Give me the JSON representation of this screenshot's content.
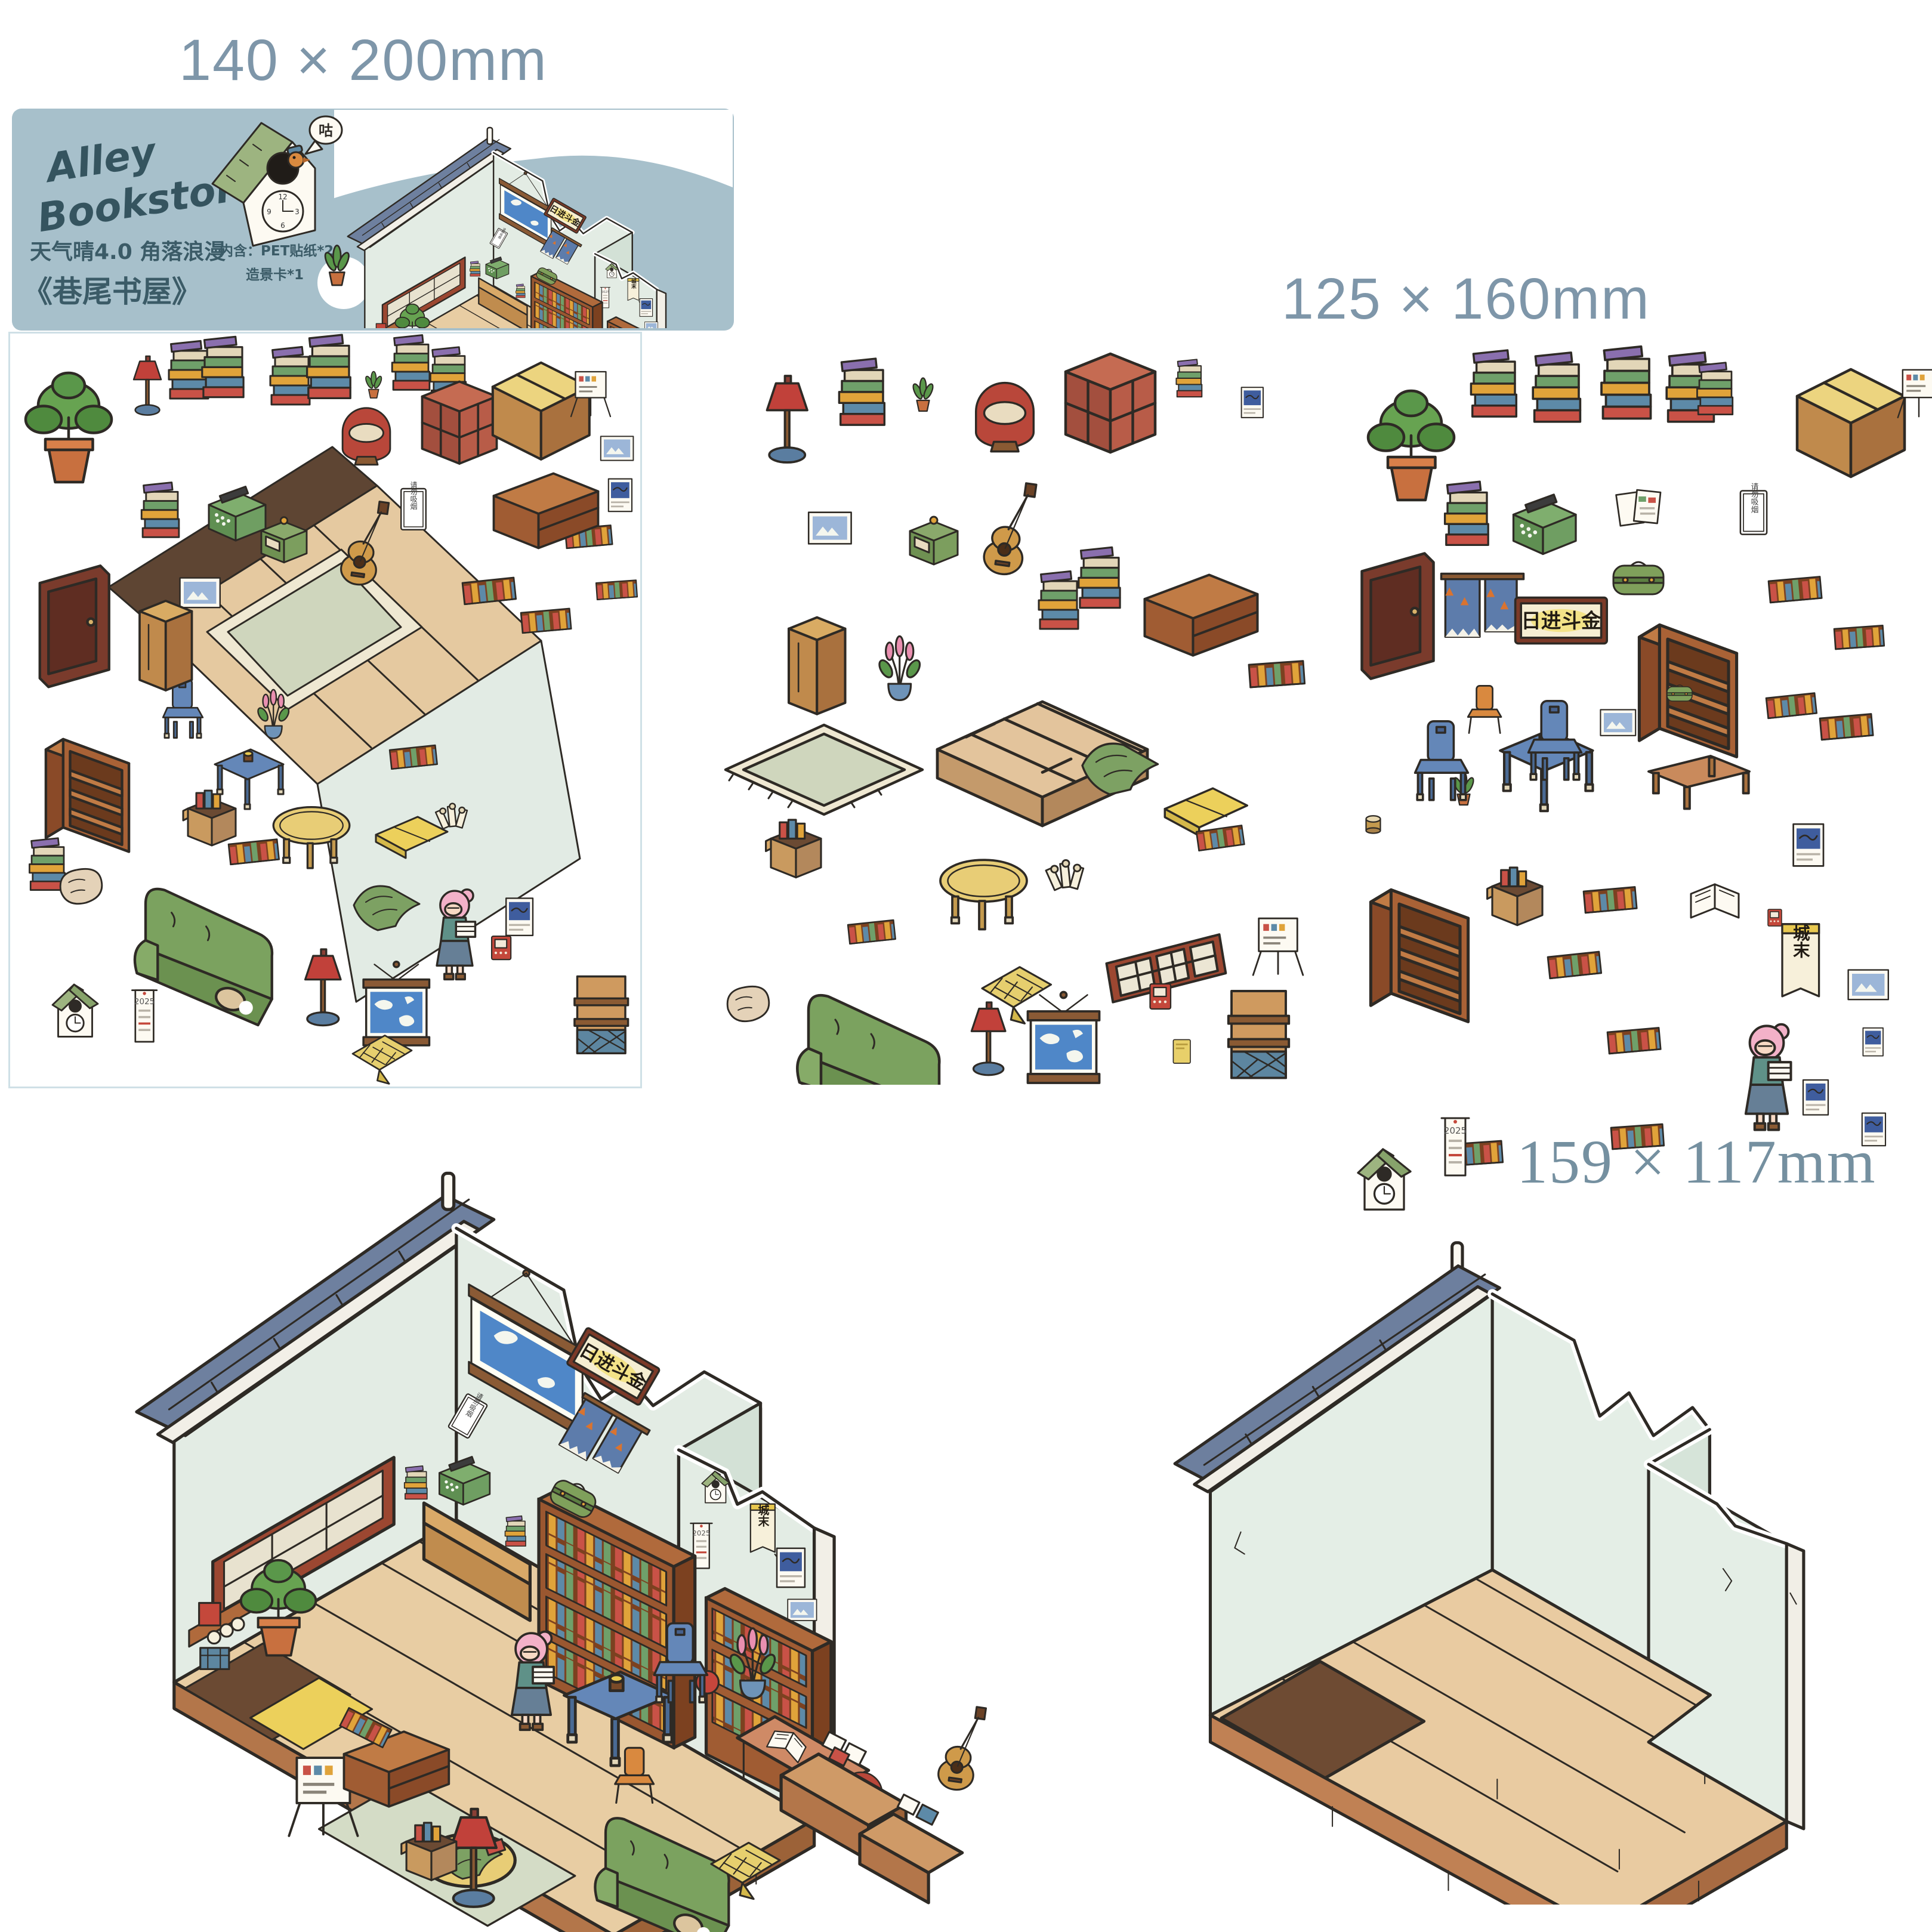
{
  "labels": {
    "package_size": "140 × 200mm",
    "sheet_size": "125 × 160mm",
    "scene_card_size": "159 × 117mm"
  },
  "package": {
    "brand_line1": "Alley",
    "brand_line2": "Bookstore",
    "series": "天气晴4.0 角落浪漫",
    "title": "《巷尾书屋》",
    "contents1": "内含：PET贴纸*2",
    "contents2": "造景卡*1",
    "clock_bubble": "咕",
    "clock": {
      "numerals": [
        "12",
        "3",
        "6",
        "9"
      ]
    },
    "bg_color": "#a7c0cb"
  },
  "artwork": {
    "plaque_text": "日进斗金",
    "scroll_text": "城末",
    "sign_text": "请勿吸烟",
    "calendar_year": "2025"
  },
  "sheets": {
    "sheet1": {
      "description": "PET sticker sheet with semi-assembled room piece",
      "items": [
        "potted-plant",
        "floor-lamp",
        "book-stacks",
        "red-armchair",
        "cube-shelf",
        "counter",
        "easel-sign",
        "typewriter",
        "gramophone-box",
        "guitar",
        "no-smoking-sign",
        "door",
        "wardrobe-column",
        "bookshelf",
        "sofa",
        "cuckoo-clock",
        "calendar",
        "floor-lamp",
        "world-map-scroll",
        "shop-girl",
        "magazine-rack",
        "wood-floor-piece",
        "rug",
        "blue-table",
        "flower-vase",
        "oval-table",
        "cushion",
        "blanket"
      ]
    },
    "sheet2": {
      "description": "PET sticker sheet of loose furniture",
      "items": [
        "floor-lamp",
        "book-stack",
        "flower-sprout",
        "red-armchair",
        "cube-shelf",
        "picture-frame",
        "gramophone-box",
        "guitar",
        "book-stacks",
        "low-cabinet",
        "wardrobe-column",
        "flower-vase",
        "wood-platform",
        "rug",
        "cardboard-box",
        "oval-table",
        "green-blanket",
        "yellow-cushion",
        "paper-rolls",
        "dust-pillow",
        "sofa",
        "yellow-cloth",
        "lattice-window",
        "easel-sign",
        "floor-lamp",
        "world-map-scroll",
        "mini-radio",
        "yellow-card",
        "magazine-rack"
      ]
    },
    "sheet3": {
      "description": "PET sticker sheet of bookstore fittings",
      "items": [
        "potted-plant",
        "book-stacks",
        "l-shaped-counter",
        "easel-sign",
        "typewriter",
        "menu-cards",
        "no-smoking-sign",
        "door",
        "noren-curtain",
        "calligraphy-plaque",
        "green-suitcase",
        "tall-bookshelf",
        "book-rows",
        "flower-sprout",
        "blue-table",
        "blue-chairs",
        "orange-chair",
        "low-table",
        "bookshelf",
        "cardboard-box",
        "open-book",
        "posters",
        "scroll-poster",
        "shop-girl",
        "cuckoo-clock",
        "calendar",
        "cup"
      ]
    },
    "scene_card": {
      "description": "empty isometric room scene card"
    }
  },
  "colors": {
    "dimension_text": "#7e96a9",
    "package_background": "#a7c0cb",
    "wall_mint": "#e3ece4",
    "wood_floor": "#e8cda3",
    "brick": "#b3764a",
    "roof": "#6e809f",
    "sofa_green": "#7ba25f",
    "shelf_brown": "#9a5730",
    "lamp_red": "#c1413a",
    "table_blue": "#6487b8"
  }
}
